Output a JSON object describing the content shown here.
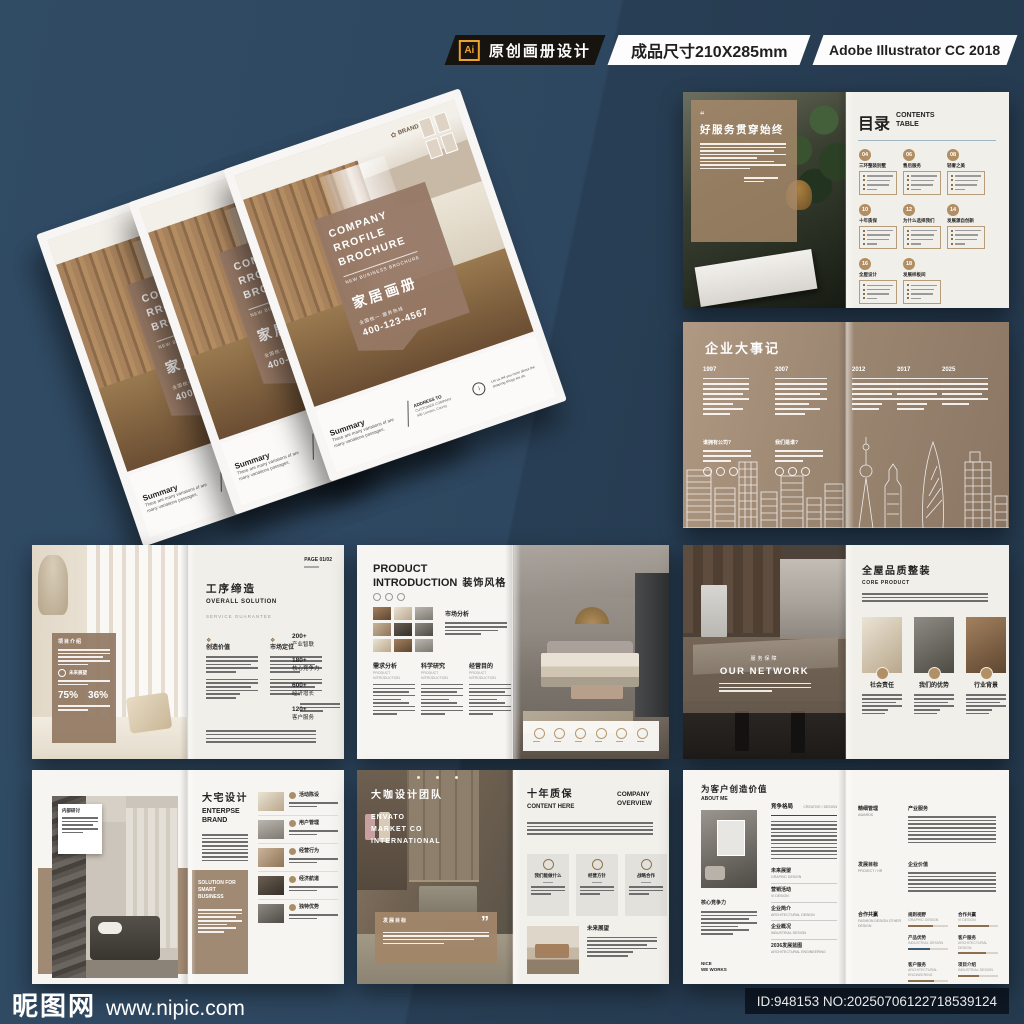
{
  "header": {
    "ai_badge": "Ai",
    "tag": "原创画册设计",
    "size": "成品尺寸210X285mm",
    "software": "Adobe Illustrator CC 2018"
  },
  "cover": {
    "brand": "BRAND",
    "flower_icon": "✿",
    "title_line1": "COMPANY",
    "title_line2": "RROFILE",
    "title_line3": "BROCHURE",
    "subtitle": "NEW BUSINESS BROCHURE",
    "cn_title": "家居画册",
    "hotline": "全国统一·服务热线",
    "phone": "400-123-4567",
    "summary_title": "Summary",
    "summary_line1": "There are many variations of  are",
    "summary_line2": "many variations passages.",
    "address_title": "ADDRESS TO",
    "address_line1": "CUSTOMER COMPANY",
    "address_line2": "495 London, County",
    "info_mark": "i",
    "note_line1": "Let us tell you more about the",
    "note_line2": "amazing things we do."
  },
  "toc": {
    "quote_mark": "“",
    "quote_title": "好服务贯穿始终",
    "title_cn": "目录",
    "title_en_line1": "CONTENTS",
    "title_en_line2": "TABLE",
    "sections": [
      {
        "num": "04",
        "title": "三环整装别墅"
      },
      {
        "num": "06",
        "title": "售后服务"
      },
      {
        "num": "08",
        "title": "轻奢之美"
      },
      {
        "num": "10",
        "title": "十年质保"
      },
      {
        "num": "12",
        "title": "为什么选择我们"
      },
      {
        "num": "14",
        "title": "发展源自创新"
      },
      {
        "num": "16",
        "title": "全屋设计"
      },
      {
        "num": "18",
        "title": "发展样板间"
      }
    ]
  },
  "timeline": {
    "title": "企业大事记",
    "years": [
      "1997",
      "2007",
      "2012",
      "2017",
      "2025"
    ],
    "question1": "谁拥有公司?",
    "question2": "我们是谁?"
  },
  "solution": {
    "overlay_title": "项目介绍",
    "overlay_sub": "未来展望",
    "stat1": "75%",
    "stat2": "36%",
    "page_label": "PAGE 01/02",
    "title_cn": "工序缔造",
    "title_en": "OVERALL SOLUTION",
    "tagline": "SERVICE GUARANTEE",
    "col1_icon": "❖",
    "col1_title": "创造价值",
    "col2_icon": "❖",
    "col2_title": "市场定位",
    "stats": [
      {
        "value": "200+",
        "label": "产业智联"
      },
      {
        "value": "180+",
        "label": "核心竞争力"
      },
      {
        "value": "600+",
        "label": "经济增长"
      },
      {
        "value": "120+",
        "label": "客户服务"
      }
    ]
  },
  "product": {
    "title_line1": "PRODUCT",
    "title_line2": "INTRODUCTION",
    "title_cn": "装饰风格",
    "market_title": "市场分析",
    "columns": [
      {
        "title": "需求分析",
        "sub": "PRODUCT INTRODUCTION"
      },
      {
        "title": "科学研究",
        "sub": "PRODUCT INTRODUCTION"
      },
      {
        "title": "经营目的",
        "sub": "PRODUCT INTRODUCTION"
      }
    ]
  },
  "network": {
    "band_cn": "服务保障",
    "band_en": "OUR NETWORK",
    "title_cn": "全屋品质整装",
    "title_en": "CORE PRODUCT",
    "cards": [
      "社会责任",
      "我们的优势",
      "行业背景"
    ]
  },
  "enterprise": {
    "callout_title": "内部研讨",
    "title_cn": "大宅设计",
    "title_en_line1": "ENTERPSE",
    "title_en_line2": "BRAND",
    "band_line1": "SOLUTION FOR",
    "band_line2": "SMART BUSINESS",
    "rows": [
      "活动陈设",
      "用户管理",
      "经营行为",
      "经济航道",
      "独特优势"
    ]
  },
  "team": {
    "title_cn": "大咖设计团队",
    "sub_line1": "ENVATO",
    "sub_line2": "MARKET CO",
    "sub_line3": "INTERNATIONAL",
    "quote_title": "发展目标",
    "quote_mark": "”",
    "right_title_cn": "十年质保",
    "right_sub": "CONTENT HERE",
    "overview_line1": "COMPANY",
    "overview_line2": "OVERVIEW",
    "cards": [
      "我们能做什么",
      "经营方针",
      "战略合作"
    ],
    "future_title": "未来展望"
  },
  "about": {
    "title": "为客户创造价值",
    "sub": "ABOUT ME",
    "core_title": "核心竞争力",
    "footer_line1": "NICE",
    "footer_line2": "WE WORKS",
    "section_title": "竞争格局",
    "section_right": "CREATIVE / DESIGN",
    "list": [
      {
        "title": "未来展望",
        "sub": "GRAPHIC DESIGN"
      },
      {
        "title": "营销活动",
        "sub": "VI DESIGN"
      },
      {
        "title": "企业简介",
        "sub": "ARCHITECTURAL DESIGN"
      },
      {
        "title": "企业概况",
        "sub": "INDUSTRIAL DESIGN"
      },
      {
        "title": "2036发展蓝图",
        "sub": "ARCHITECTURAL ENGINEERING"
      }
    ],
    "colA": [
      {
        "title": "精细管理",
        "sub": "AWARDS"
      },
      {
        "title": "发展目标",
        "sub": "PROJECT / HR"
      },
      {
        "title": "合作共赢",
        "sub": "FASHION DESIGN OTHER DESIGN"
      }
    ],
    "colB_title1": "产业服务",
    "colB_title2": "企业价值",
    "skills": [
      {
        "title": "规则视野",
        "sub": "GRAPHIC DESIGN",
        "value": 62
      },
      {
        "title": "合作共赢",
        "sub": "VI DESIGN",
        "value": 78
      },
      {
        "title": "产品优势",
        "sub": "INDUSTRIAL DESIGN",
        "value": 55
      },
      {
        "title": "客户服务",
        "sub": "ARCHITECTURAL DESIGN",
        "value": 70
      },
      {
        "title": "客户服务",
        "sub": "ARCHITECTURAL ENGINEERING",
        "value": 66
      },
      {
        "title": "项目介绍",
        "sub": "INDUSTRIAL DESIGN",
        "value": 52
      }
    ]
  },
  "watermark": {
    "site_name": "昵图网",
    "site_url": "www.nipic.com",
    "id_text": "ID:948153 NO:20250706122718539124"
  },
  "colors": {
    "background": "#2c4459",
    "accent_tan": "#ae8f68",
    "brown_overlay": "#97785f",
    "page_cream": "#f1efe9",
    "banner_black": "#17130f",
    "ai_orange": "#efa02e"
  }
}
